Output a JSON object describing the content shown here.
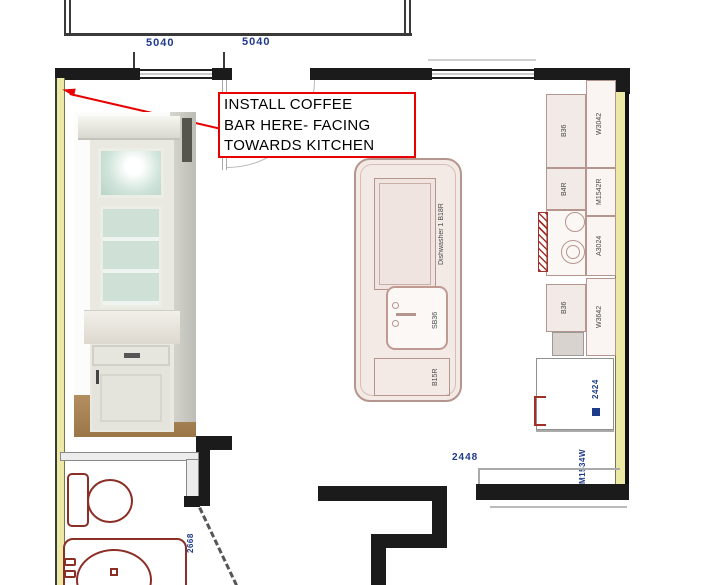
{
  "annotation": {
    "lines": [
      "INSTALL COFFEE",
      "BAR HERE- FACING",
      "TOWARDS KITCHEN"
    ]
  },
  "dimensions": {
    "window_left": "5040",
    "window_right": "5040",
    "opening_bottom": "2448",
    "bath_door": "2668",
    "fridge_code": "2424",
    "right_lower_code": "M1534W"
  },
  "island": {
    "dishwasher": "Dishwasher 1 B18R",
    "sink": "SB36",
    "base_cabinet": "B15R"
  },
  "right_run": {
    "wall_cabinets": [
      "W3042",
      "M1542R",
      "A3024",
      "W3642"
    ],
    "base_cabinets": [
      "B36",
      "B4R",
      "B36"
    ]
  },
  "colors": {
    "annotation_red": "#e80000",
    "dimension_blue": "#1e3a8a",
    "wall_yellow": "#ece9a4",
    "plan_outline": "#b5968e",
    "fixture_maroon": "#8b2e26"
  }
}
